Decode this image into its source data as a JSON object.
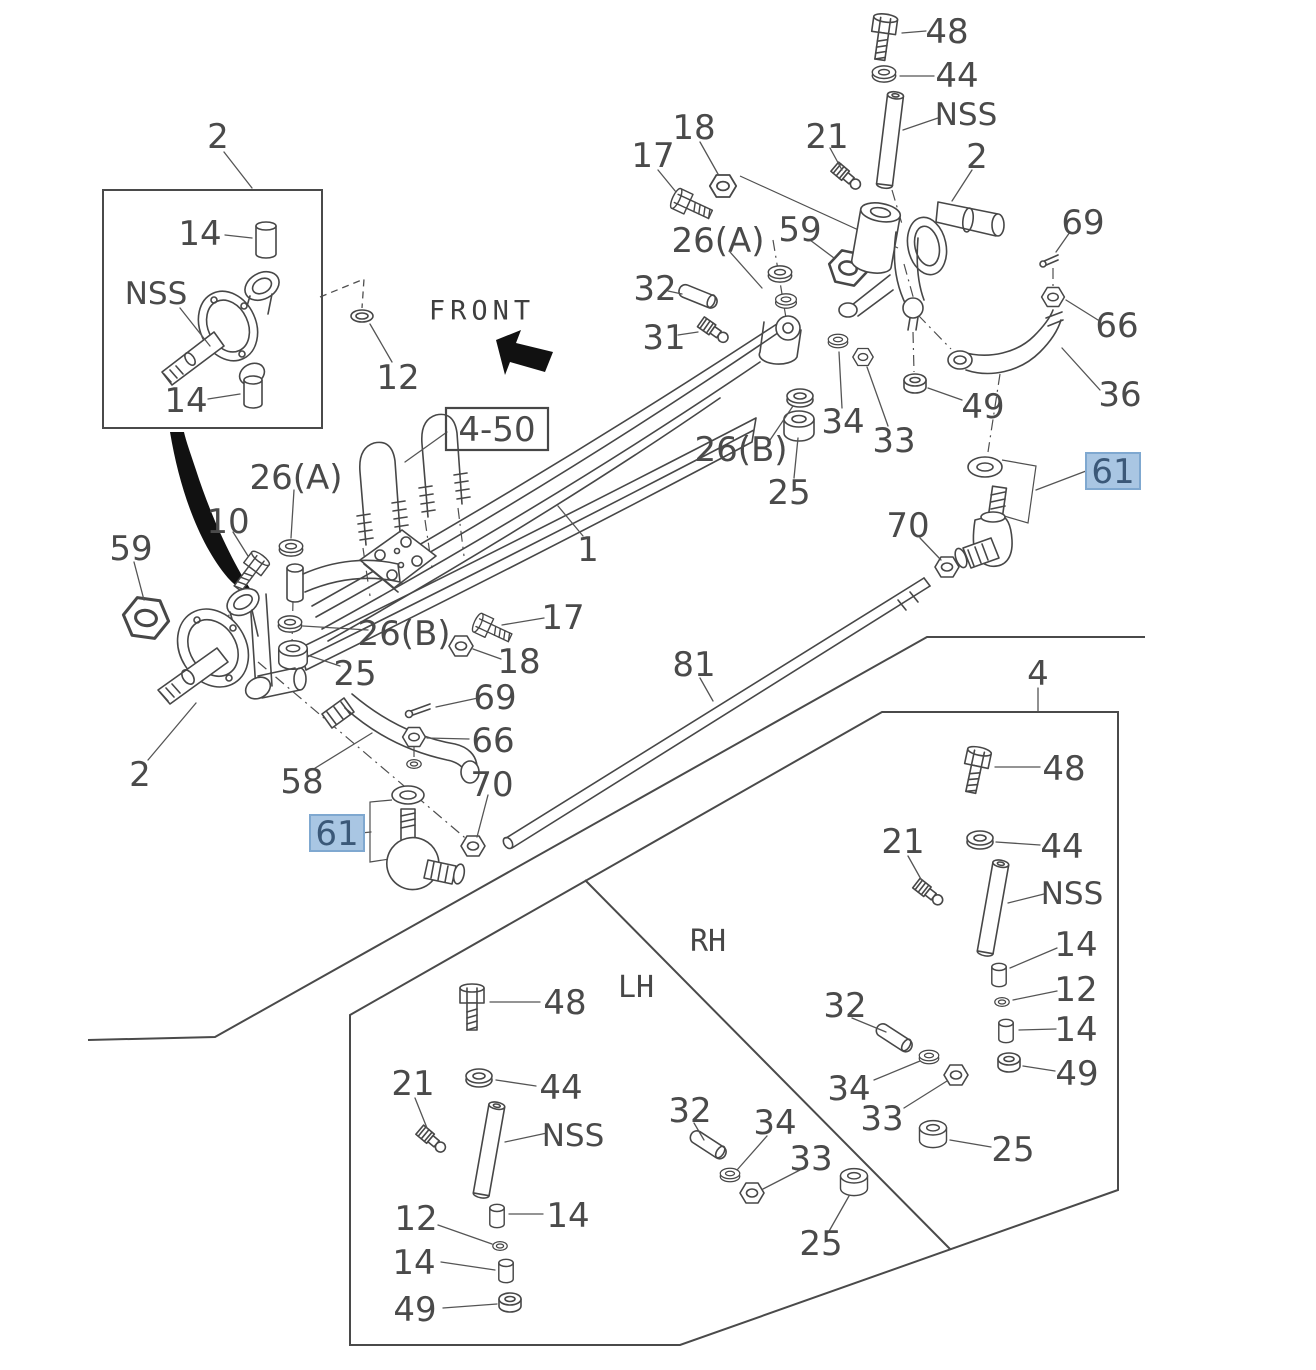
{
  "diagram": {
    "type": "parts-exploded-diagram",
    "highlighted_part_number": "61",
    "section_reference": "4-50",
    "orientation_label": "FRONT"
  },
  "colors": {
    "background": "#ffffff",
    "line_art": "#474747",
    "label_text": "#4a4a4a",
    "highlight_fill": "#a9c6e3",
    "highlight_border": "#7fa8d0",
    "highlight_text": "#3b5878"
  },
  "labels": [
    {
      "text": "2",
      "x": 218,
      "y": 136
    },
    {
      "text": "14",
      "x": 200,
      "y": 233
    },
    {
      "text": "NSS",
      "x": 156,
      "y": 293,
      "kind": "nss"
    },
    {
      "text": "14",
      "x": 186,
      "y": 400
    },
    {
      "text": "12",
      "x": 398,
      "y": 377
    },
    {
      "text": "FRONT",
      "x": 482,
      "y": 310,
      "kind": "front"
    },
    {
      "text": "17",
      "x": 653,
      "y": 155
    },
    {
      "text": "18",
      "x": 694,
      "y": 127
    },
    {
      "text": "21",
      "x": 827,
      "y": 136
    },
    {
      "text": "48",
      "x": 947,
      "y": 31
    },
    {
      "text": "44",
      "x": 957,
      "y": 75
    },
    {
      "text": "NSS",
      "x": 966,
      "y": 114,
      "kind": "nss"
    },
    {
      "text": "2",
      "x": 977,
      "y": 156
    },
    {
      "text": "69",
      "x": 1083,
      "y": 222
    },
    {
      "text": "66",
      "x": 1117,
      "y": 325
    },
    {
      "text": "36",
      "x": 1120,
      "y": 394
    },
    {
      "text": "26(A)",
      "x": 718,
      "y": 240
    },
    {
      "text": "59",
      "x": 800,
      "y": 229
    },
    {
      "text": "32",
      "x": 655,
      "y": 288
    },
    {
      "text": "31",
      "x": 664,
      "y": 337
    },
    {
      "text": "26(B)",
      "x": 741,
      "y": 449
    },
    {
      "text": "25",
      "x": 789,
      "y": 492
    },
    {
      "text": "34",
      "x": 843,
      "y": 421
    },
    {
      "text": "33",
      "x": 894,
      "y": 440
    },
    {
      "text": "49",
      "x": 983,
      "y": 406
    },
    {
      "text": "61",
      "x": 1113,
      "y": 471,
      "highlight": true
    },
    {
      "text": "70",
      "x": 908,
      "y": 525
    },
    {
      "text": "59",
      "x": 131,
      "y": 548
    },
    {
      "text": "10",
      "x": 228,
      "y": 521
    },
    {
      "text": "26(A)",
      "x": 296,
      "y": 477
    },
    {
      "text": "4-50",
      "x": 497,
      "y": 429,
      "box": true
    },
    {
      "text": "1",
      "x": 588,
      "y": 549
    },
    {
      "text": "26(B)",
      "x": 404,
      "y": 633
    },
    {
      "text": "25",
      "x": 355,
      "y": 673
    },
    {
      "text": "17",
      "x": 563,
      "y": 617
    },
    {
      "text": "18",
      "x": 519,
      "y": 661
    },
    {
      "text": "69",
      "x": 495,
      "y": 697
    },
    {
      "text": "66",
      "x": 493,
      "y": 740
    },
    {
      "text": "70",
      "x": 492,
      "y": 784
    },
    {
      "text": "2",
      "x": 140,
      "y": 774
    },
    {
      "text": "58",
      "x": 302,
      "y": 781
    },
    {
      "text": "61",
      "x": 337,
      "y": 833,
      "highlight": true
    },
    {
      "text": "81",
      "x": 694,
      "y": 664
    },
    {
      "text": "4",
      "x": 1038,
      "y": 673
    },
    {
      "text": "48",
      "x": 1064,
      "y": 768
    },
    {
      "text": "21",
      "x": 903,
      "y": 841
    },
    {
      "text": "44",
      "x": 1062,
      "y": 846
    },
    {
      "text": "NSS",
      "x": 1072,
      "y": 893,
      "kind": "nss"
    },
    {
      "text": "14",
      "x": 1076,
      "y": 944
    },
    {
      "text": "12",
      "x": 1076,
      "y": 989
    },
    {
      "text": "14",
      "x": 1076,
      "y": 1029
    },
    {
      "text": "49",
      "x": 1077,
      "y": 1073
    },
    {
      "text": "32",
      "x": 845,
      "y": 1005
    },
    {
      "text": "34",
      "x": 849,
      "y": 1088
    },
    {
      "text": "33",
      "x": 882,
      "y": 1118
    },
    {
      "text": "25",
      "x": 1013,
      "y": 1149
    },
    {
      "text": "RH",
      "x": 708,
      "y": 940,
      "kind": "side"
    },
    {
      "text": "LH",
      "x": 636,
      "y": 986,
      "kind": "side"
    },
    {
      "text": "48",
      "x": 565,
      "y": 1002
    },
    {
      "text": "21",
      "x": 413,
      "y": 1083
    },
    {
      "text": "44",
      "x": 561,
      "y": 1087
    },
    {
      "text": "NSS",
      "x": 573,
      "y": 1135,
      "kind": "nss"
    },
    {
      "text": "12",
      "x": 416,
      "y": 1218
    },
    {
      "text": "14",
      "x": 568,
      "y": 1215
    },
    {
      "text": "14",
      "x": 414,
      "y": 1262
    },
    {
      "text": "49",
      "x": 415,
      "y": 1309
    },
    {
      "text": "32",
      "x": 690,
      "y": 1110
    },
    {
      "text": "34",
      "x": 775,
      "y": 1122
    },
    {
      "text": "33",
      "x": 811,
      "y": 1158
    },
    {
      "text": "25",
      "x": 821,
      "y": 1243
    }
  ]
}
